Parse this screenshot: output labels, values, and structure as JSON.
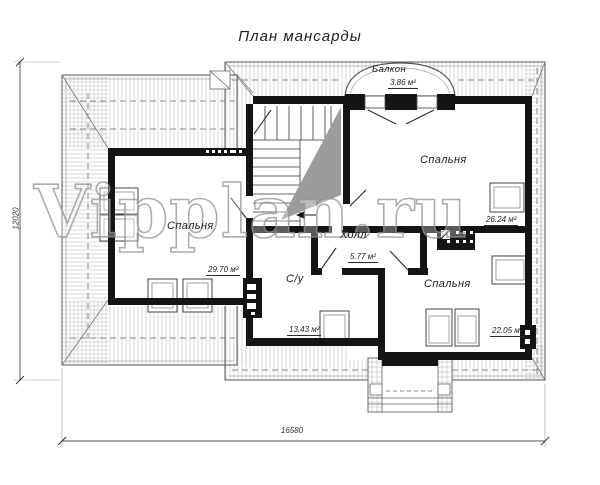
{
  "title": "План мансарды",
  "watermark": "Vipplan.ru",
  "rooms": {
    "balcony": {
      "name": "Балкон",
      "area": "3.86 м²"
    },
    "bedroom_top_right": {
      "name": "Спальня",
      "area": "26.24 м²"
    },
    "bedroom_left": {
      "name": "Спальня",
      "area": "29.70 м²"
    },
    "hall": {
      "name": "Холл",
      "area": "5.77 м²"
    },
    "bathroom": {
      "name": "С/у",
      "area": "13.43 м²"
    },
    "bedroom_bottom_right": {
      "name": "Спальня",
      "area": "22.05 м²"
    }
  },
  "dimensions": {
    "height_total": "12020",
    "width_total": "16580"
  },
  "colors": {
    "wall": "#141414",
    "roof_hatch": "#c9c9c9",
    "stair_void_shade": "#9c9c9c",
    "dashed_line": "#8a8a8a"
  }
}
